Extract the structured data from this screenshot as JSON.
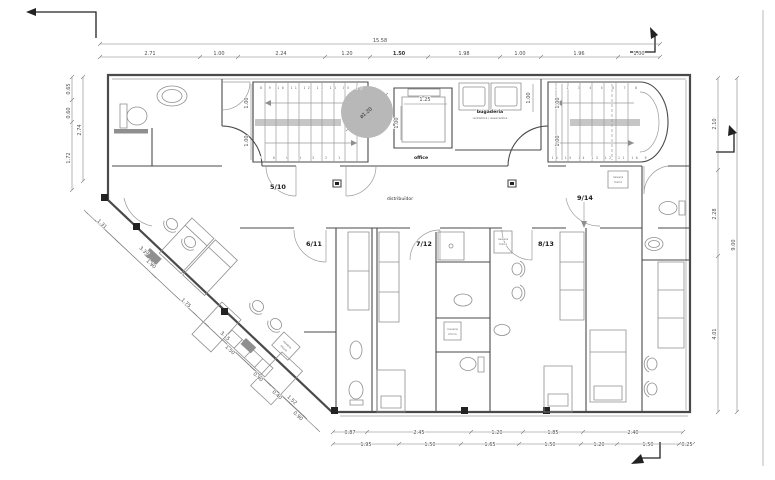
{
  "plan": {
    "rooms": {
      "r510": "5/10",
      "r611": "6/11",
      "r712": "7/12",
      "r813": "8/13",
      "r914": "9/14",
      "office": "office",
      "corridor": "distribuïdor",
      "laundry_title": "bugaderia",
      "laundry_sub": "rentadora / assecadora",
      "fridge_line1": "nevera",
      "fridge_line2": "micro"
    },
    "stairs": {
      "left_top": "8 9 10 11 12 13 14 15 16",
      "left_bottom": "7 6 5 4 3 2 1",
      "right_top": "1 2 3 4 5 6 7 8",
      "right_bottom": "16 15 14 13 12 11 10 9"
    },
    "dims": {
      "top_total": "15.58",
      "top": [
        "2.71",
        "1.00",
        "2.24",
        "1.20",
        "1.50",
        "1.98",
        "1.00",
        "1.96",
        "1.00"
      ],
      "left": [
        "0.65",
        "0.60"
      ],
      "left_total": "2.74",
      "left_lower": "1.72",
      "right": [
        "2.10",
        "2.28",
        "4.01"
      ],
      "right_total": "9.00",
      "bottom_upper": [
        "0.87",
        "2.45",
        "1.20",
        "1.85",
        "2.40"
      ],
      "bottom_lower": [
        "1.95",
        "1.50",
        "1.65",
        "1.50",
        "1.20",
        "1.50",
        "0.25"
      ],
      "diag_outer": [
        "1.31",
        "3.37",
        "3.15",
        "1.52"
      ],
      "diag_inner": [
        "1.90",
        "1.75",
        "1.50",
        "0.90",
        "0.40",
        "0.90"
      ],
      "shaft_width": "1.25",
      "stair_run": "1.00",
      "circle_diameter": "ø1.20"
    }
  }
}
